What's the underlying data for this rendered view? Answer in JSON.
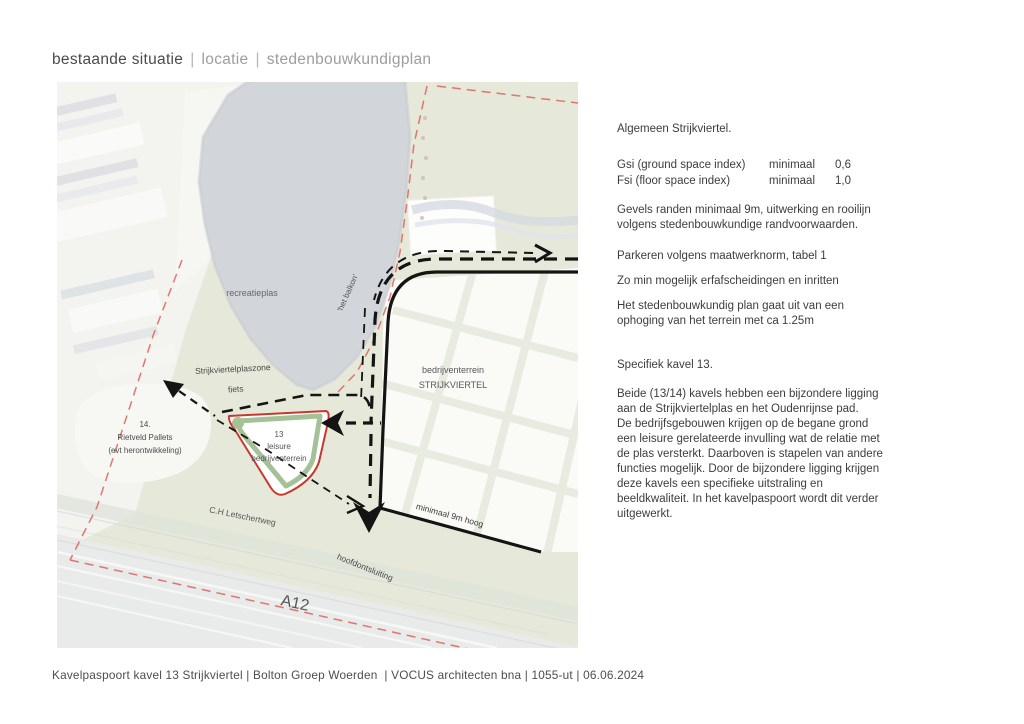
{
  "header": {
    "title_part1": "bestaande situatie",
    "title_part2": "locatie",
    "title_part3": "stedenbouwkundigplan",
    "separator": "|"
  },
  "map": {
    "recreatieplas": "recreatieplas",
    "het_balkon": "'het balkon'",
    "strijkviertelplaszone": "Strijkviertelplaszone",
    "fiets": "fiets",
    "kavel14": {
      "lines": [
        "14.",
        "Rietveld Pallets",
        "(evt herontwikkeling)"
      ]
    },
    "kavel13": {
      "lines": [
        "13",
        "leisure",
        "bedrijventerrein"
      ]
    },
    "bedrijventerrein": {
      "lines": [
        "bedrijventerrein",
        "STRIJKVIERTEL"
      ]
    },
    "minimaal": "minimaal 9m hoog",
    "hoofdontsluiting": "hoofdontsluiting",
    "letschertweg": "C.H Letschertweg",
    "a12": "A12"
  },
  "notes": {
    "algemeen_heading": "Algemeen Strijkviertel.",
    "index_rows": [
      {
        "label": "Gsi (ground space index)",
        "qualifier": "minimaal",
        "value": "0,6"
      },
      {
        "label": "Fsi (floor space index)",
        "qualifier": "minimaal",
        "value": "1,0"
      }
    ],
    "para_gevels": "Gevels randen minimaal 9m, uitwerking en rooilijn\nvolgens stedenbouwkundige randvoorwaarden.",
    "para_parkeren": "Parkeren volgens maatwerknorm, tabel 1",
    "para_erf": "Zo min mogelijk erfafscheidingen en inritten",
    "para_ophoging": "Het stedenbouwkundig plan gaat uit van een\nophoging van het terrein met ca 1.25m",
    "specifiek_heading": "Specifiek kavel 13.",
    "para_specifiek": "Beide (13/14) kavels hebben een bijzondere ligging\naan de Strijkviertelplas en het Oudenrijnse pad.\nDe bedrijfsgebouwen krijgen op de begane grond\neen leisure gerelateerde invulling wat de relatie met\nde plas versterkt. Daarboven is stapelen van andere\nfuncties mogelijk. Door de bijzondere ligging krijgen\ndeze kavels een specifieke uitstraling en\nbeeldkwaliteit. In het kavelpaspoort wordt dit verder\nuitgewerkt."
  },
  "footer": {
    "line": "Kavelpaspoort kavel 13 Strijkviertel | Bolton Groep Woerden  | VOCUS architecten bna | 1055-ut | 06.06.2024"
  },
  "colors": {
    "boundary_red": "#dd6257",
    "parcel_outline_red": "#c8382c",
    "parcel_green": "#a5c197",
    "water": "#d2d5da",
    "plan_green": "#e4e8d7",
    "road_black": "#141414"
  }
}
